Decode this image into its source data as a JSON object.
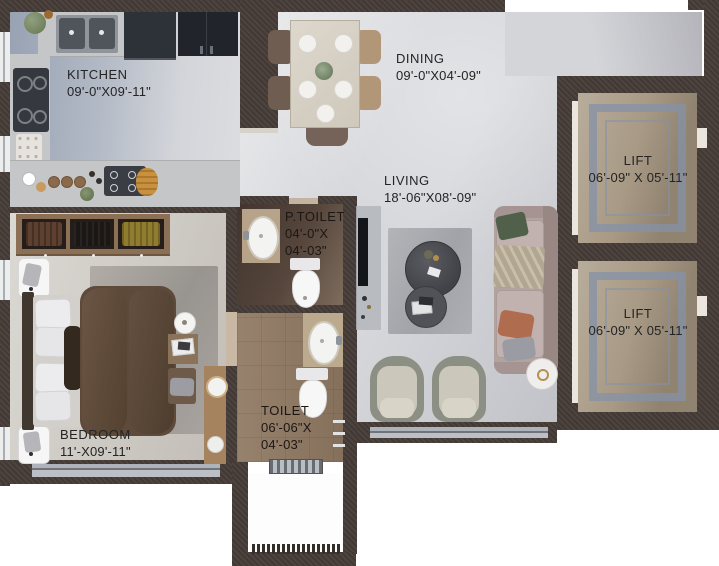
{
  "title": "apartment-floor-plan",
  "rooms": {
    "kitchen": {
      "name": "KITCHEN",
      "dims": "09'-0\"X09'-11\""
    },
    "dining": {
      "name": "DINING",
      "dims": "09'-0\"X04'-09\""
    },
    "living": {
      "name": "LIVING",
      "dims": "18'-06\"X08'-09\""
    },
    "ptoilet": {
      "name": "P.TOILET",
      "dims1": "04'-0\"X",
      "dims2": "04'-03\""
    },
    "toilet": {
      "name": "TOILET",
      "dims1": "06'-06\"X",
      "dims2": "04'-03\""
    },
    "bedroom": {
      "name": "BEDROOM",
      "dims": "11'-X09'-11\""
    },
    "lift_top": {
      "name": "LIFT",
      "dims": "06'-09\" X 05'-11\""
    },
    "lift_bottom": {
      "name": "LIFT",
      "dims": "06'-09\" X 05'-11\""
    }
  },
  "colors": {
    "wall": "#463c37",
    "floor_main": "#d6d7db",
    "floor_kitchen": "#98a2b3",
    "floor_bedroom": "#cdc9c3",
    "floor_ptoilet": "#4b3d37",
    "floor_toilet": "#8e7763",
    "floor_lift": "#a89a85",
    "lift_inlay": "#8d97a7",
    "label_text": "#242424",
    "sofa": "#b2a3a0",
    "duvet": "#5e4a3a",
    "wood": "#8c7055"
  }
}
